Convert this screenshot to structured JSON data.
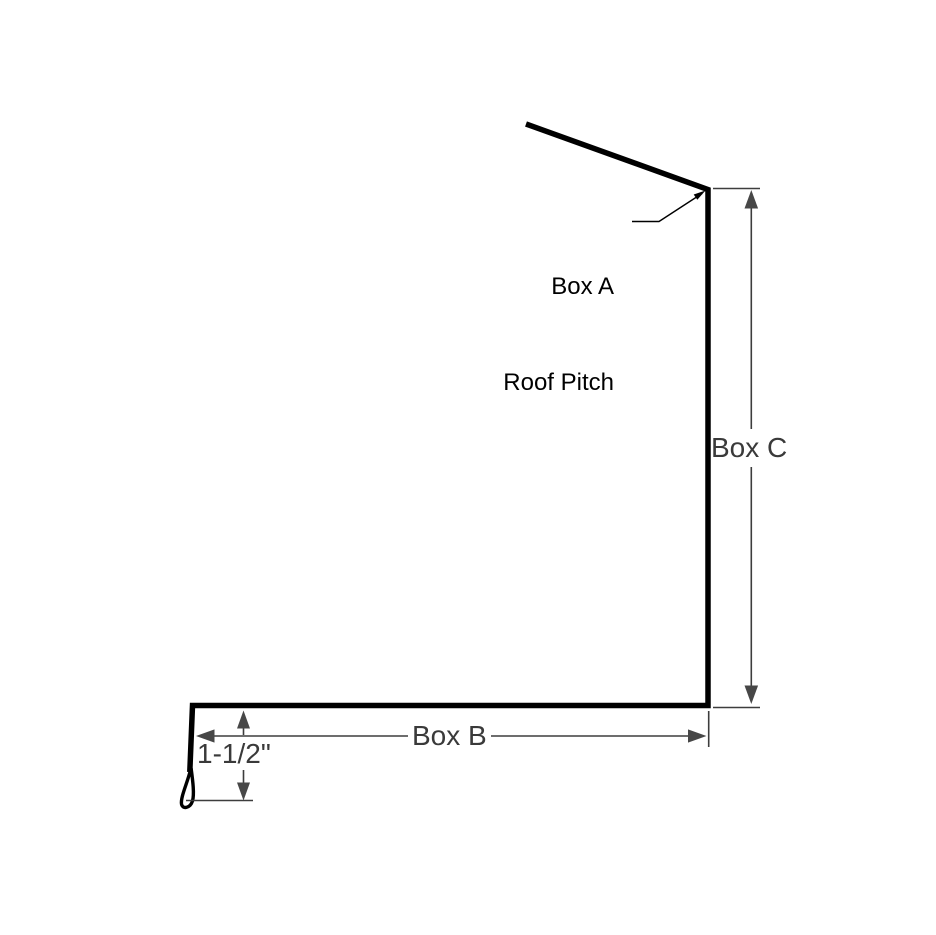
{
  "diagram": {
    "kind": "trim-profile-drawing",
    "callout": {
      "line1": "Box A",
      "line2": "Roof Pitch"
    },
    "dimensions": {
      "vertical_label": "Box C",
      "horizontal_label": "Box B",
      "hem_label": "1-1/2\""
    },
    "icons": {
      "callout_arrow": "arrow-up-right",
      "vertical_dim_arrows": "arrow-up / arrow-down",
      "horizontal_dim_arrows": "arrow-left / arrow-right",
      "hem_dim_arrows": "arrow-up / arrow-down"
    },
    "colors": {
      "background": "#ffffff",
      "profile": "#000000",
      "dimension_line": "#3d3d3d",
      "arrow_fill": "#474747",
      "callout_text": "#000000",
      "dimension_text": "#3a3a3a"
    }
  }
}
